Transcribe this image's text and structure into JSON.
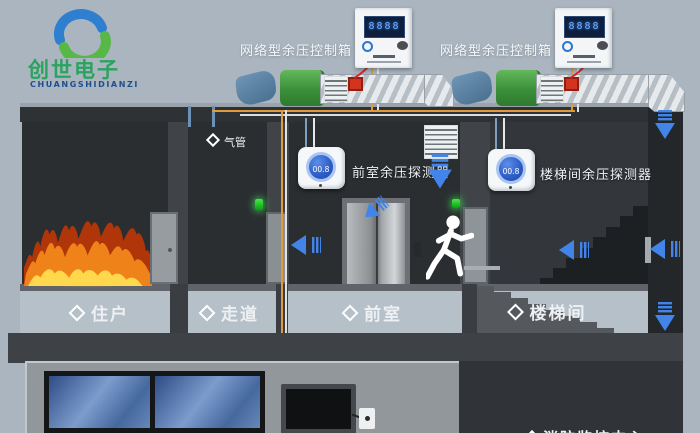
{
  "logo": {
    "title": "创世电子",
    "subtitle": "CHUANGSHIDIANZI"
  },
  "control_boxes": {
    "left_label": "网络型余压控制箱",
    "right_label": "网络型余压控制箱",
    "screen_text": "8888"
  },
  "detectors": {
    "front_room": {
      "label": "前室余压探测器",
      "display": "00.8"
    },
    "stairwell": {
      "label": "楼梯间余压探测器",
      "display": "00.8"
    }
  },
  "pipe_label": "气管",
  "rooms": [
    {
      "id": "resident",
      "label": "住户"
    },
    {
      "id": "corridor",
      "label": "走道"
    },
    {
      "id": "front-room",
      "label": "前室"
    },
    {
      "id": "stairwell",
      "label": "楼梯间"
    }
  ],
  "monitoring_center": {
    "label": "消防监控中心"
  },
  "colors": {
    "background": "#aab5bf",
    "room_dark": "#2b2e31",
    "label_band": "#b6c0c8",
    "arrow_blue": "#4285ea",
    "cable_orange": "#e09a3a",
    "duct_green": "#4fa348",
    "fan_blue": "#5c85a8",
    "alarm_red": "#d23420"
  }
}
